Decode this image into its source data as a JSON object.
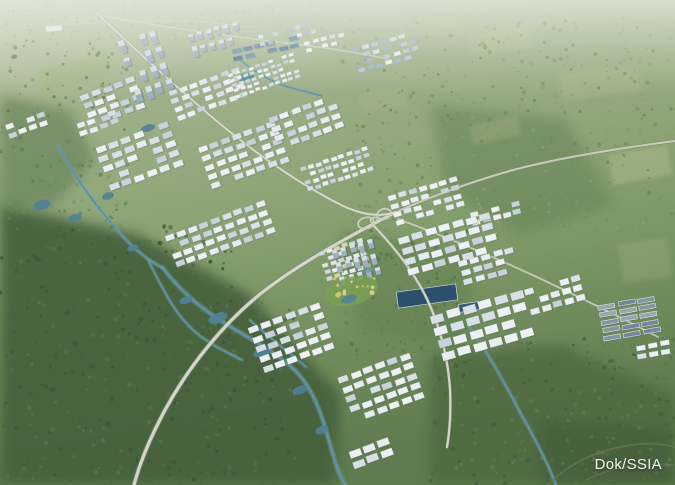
{
  "meta": {
    "credit": "Dok/SSIA",
    "alt": "Aerial masterplan rendering of a large industrial smart-city estate surrounded by green fields and forest"
  },
  "palette": {
    "bgStops": [
      [
        0,
        "#c3cdb3"
      ],
      [
        0.25,
        "#9eb089"
      ],
      [
        0.5,
        "#8ba374"
      ],
      [
        0.75,
        "#75905f"
      ],
      [
        1,
        "#5f7b4f"
      ]
    ],
    "haze": "#e9ede4",
    "water": "#5e93a5",
    "waterGlow": "#7fa9b6",
    "lakeDeep": "#2b506b",
    "roadLight": "#d3d7c8",
    "roadCase": "#7e8770",
    "roofWhite": "#eef1f3",
    "roofBlue": "#d7e0e6",
    "towerBody": "#9db0c0",
    "towerCap": "#d6dfe6",
    "panelBlue": "#5d80a0",
    "creditColor": "#f2f3f1"
  },
  "scene": {
    "regions": [
      {
        "points": "0,205 140,235 250,295 340,395 335,485 0,485",
        "fill": "#46613e",
        "op": 0.92
      },
      {
        "points": "0,95 70,110 95,160 55,205 0,215",
        "fill": "#5d7950",
        "op": 0.55
      },
      {
        "points": "430,105 565,118 615,205 520,235 445,190",
        "fill": "#647f53",
        "op": 0.5
      },
      {
        "points": "430,355 560,345 675,395 675,485 430,485",
        "fill": "#4d6640",
        "op": 0.75
      },
      {
        "points": "540,420 675,430 675,485 540,485",
        "fill": "#3f5838",
        "op": 0.5
      },
      {
        "points": "340,230 470,250 470,350 360,330",
        "fill": "#5f7c4e",
        "op": 0.45
      }
    ],
    "patches": [
      {
        "x": 470,
        "y": 30,
        "w": 60,
        "h": 22,
        "rot": -8,
        "fill": "#b4bf93",
        "op": 0.4
      },
      {
        "x": 560,
        "y": 70,
        "w": 80,
        "h": 26,
        "rot": -6,
        "fill": "#aeb98d",
        "op": 0.4
      },
      {
        "x": 610,
        "y": 150,
        "w": 60,
        "h": 30,
        "rot": -10,
        "fill": "#b7c197",
        "op": 0.4
      },
      {
        "x": 470,
        "y": 120,
        "w": 50,
        "h": 20,
        "rot": -12,
        "fill": "#a9b588",
        "op": 0.35
      },
      {
        "x": 360,
        "y": 90,
        "w": 46,
        "h": 18,
        "rot": -10,
        "fill": "#b0bb90",
        "op": 0.3
      },
      {
        "x": 620,
        "y": 240,
        "w": 50,
        "h": 40,
        "rot": -8,
        "fill": "#9fae82",
        "op": 0.35
      },
      {
        "x": 40,
        "y": 60,
        "w": 70,
        "h": 24,
        "rot": -14,
        "fill": "#9db378",
        "op": 0.3
      }
    ],
    "treeZones": [
      {
        "x": 0,
        "y": 225,
        "w": 235,
        "h": 260,
        "n": 420,
        "rmin": 0.8,
        "rmax": 2.4,
        "colors": [
          "#3c5839",
          "#476441",
          "#54724b"
        ],
        "op": 0.9
      },
      {
        "x": 200,
        "y": 300,
        "w": 95,
        "h": 185,
        "n": 130,
        "rmin": 0.8,
        "rmax": 2.2,
        "colors": [
          "#3c5839",
          "#476441",
          "#54724b"
        ],
        "op": 0.9
      },
      {
        "x": 340,
        "y": 15,
        "w": 335,
        "h": 215,
        "n": 400,
        "rmin": 0.7,
        "rmax": 2.0,
        "colors": [
          "#6d8859",
          "#7b9263",
          "#87a06d"
        ],
        "op": 0.85
      },
      {
        "x": 430,
        "y": 335,
        "w": 245,
        "h": 150,
        "n": 290,
        "rmin": 0.8,
        "rmax": 2.3,
        "colors": [
          "#465f3c",
          "#527046",
          "#5d7b50"
        ],
        "op": 0.9
      },
      {
        "x": 0,
        "y": 40,
        "w": 130,
        "h": 190,
        "n": 160,
        "rmin": 0.8,
        "rmax": 2.2,
        "colors": [
          "#5f7a50",
          "#6c8759",
          "#78935f"
        ],
        "op": 0.85
      },
      {
        "x": 130,
        "y": 0,
        "w": 220,
        "h": 40,
        "n": 110,
        "rmin": 0.6,
        "rmax": 1.6,
        "colors": [
          "#8ba272",
          "#96ab7c"
        ],
        "op": 0.6
      },
      {
        "x": 340,
        "y": 230,
        "w": 130,
        "h": 125,
        "n": 150,
        "rmin": 0.8,
        "rmax": 2.2,
        "colors": [
          "#55744a",
          "#617f52",
          "#6d8a58"
        ],
        "op": 0.85
      },
      {
        "x": 0,
        "y": 0,
        "w": 130,
        "h": 45,
        "n": 60,
        "rmin": 0.6,
        "rmax": 1.6,
        "colors": [
          "#93a87e"
        ],
        "op": 0.55
      }
    ],
    "rivers": [
      {
        "d": "M 58,146 C 74,176 96,206 118,231 C 136,252 151,262 163,268",
        "w": 2.2
      },
      {
        "d": "M 163,268 C 186,299 214,317 236,330 C 261,345 286,359 301,377 C 316,396 323,419 330,444 C 335,463 340,476 345,485",
        "w": 2.6
      },
      {
        "d": "M 148,260 C 163,289 174,313 194,331 C 209,344 226,352 242,360",
        "w": 1.8
      },
      {
        "d": "M 250,320 C 268,337 288,351 306,367",
        "w": 1.6
      },
      {
        "d": "M 470,328 C 489,354 505,384 521,414 C 534,437 547,461 556,485",
        "w": 2.0
      },
      {
        "d": "M 238,58 C 252,70 266,79 282,85 C 296,90 310,92 322,96",
        "w": 1.6
      }
    ],
    "ponds": [
      [
        42,
        205,
        9,
        5,
        -15
      ],
      [
        75,
        218,
        7,
        4,
        -15
      ],
      [
        108,
        196,
        6,
        3.5,
        -15
      ],
      [
        246,
        77,
        8,
        4,
        -12
      ],
      [
        218,
        318,
        10,
        5,
        -20
      ],
      [
        262,
        352,
        9,
        4.5,
        -20
      ],
      [
        300,
        390,
        8,
        4,
        -20
      ],
      [
        322,
        430,
        7,
        4,
        -20
      ],
      [
        133,
        248,
        6,
        3,
        -15
      ],
      [
        186,
        300,
        7,
        3.5,
        -18
      ],
      [
        148,
        128,
        7,
        3.5,
        -15
      ]
    ],
    "lakes": [
      {
        "x": 397,
        "y": 288,
        "w": 60,
        "h": 16,
        "rot": -8,
        "fill": "#2b506b"
      },
      {
        "x": 459,
        "y": 303,
        "w": 20,
        "h": 8,
        "rot": -8,
        "fill": "#335972"
      }
    ],
    "roads": [
      {
        "d": "M 0,31 C 45,26 90,22 132,21 C 170,20 215,22 254,27",
        "w": 1.2,
        "color": "#c4cbb8",
        "op": 0.75
      },
      {
        "d": "M 98,15 C 152,25 212,34 270,41 C 312,46 352,51 388,59",
        "w": 1.4,
        "color": "#ced3c2",
        "op": 0.85
      },
      {
        "d": "M 675,141 C 612,149 548,160 506,172 C 468,183 430,197 396,212",
        "w": 2.0,
        "color": "#c6ccba",
        "case": "#7e8770",
        "cw": 3.4
      },
      {
        "d": "M 396,212 C 348,237 302,262 264,291 C 222,324 188,368 165,410 C 150,438 140,462 134,485",
        "w": 3.2,
        "color": "#d3d7c8",
        "case": "#7e8770",
        "cw": 5
      },
      {
        "d": "M 97,13 C 131,46 172,83 213,118 C 256,154 300,184 341,205 C 360,214 378,218 396,212",
        "w": 2.0,
        "color": "#d6dacb",
        "case": "#8a937e",
        "cw": 3.2
      },
      {
        "d": "M 374,226 C 396,249 414,272 427,299 C 441,329 448,359 450,389 C 451,411 450,430 447,447",
        "w": 2.2,
        "color": "#d2d6c6",
        "case": "#8a937e",
        "cw": 3.2
      },
      {
        "d": "M 398,219 C 444,236 492,256 541,279 C 577,296 618,316 658,337",
        "w": 1.8,
        "color": "#c9cfbc",
        "op": 0.9
      },
      {
        "d": "M 548,485 C 570,462 600,448 640,444 C 652,443 664,444 675,447",
        "w": 1.8,
        "color": "#667557",
        "op": 0.8
      },
      {
        "d": "M 675,465 C 640,462 610,468 586,480",
        "w": 1.5,
        "color": "#667557",
        "op": 0.7
      }
    ],
    "loops": [
      {
        "cx": 366,
        "cy": 223,
        "rx": 8,
        "ry": 5.5,
        "rot": -15
      },
      {
        "cx": 384,
        "cy": 214,
        "rx": 7,
        "ry": 5,
        "rot": -15
      },
      {
        "cx": 374,
        "cy": 220,
        "rx": 3.5,
        "ry": 2.6,
        "rot": -15
      }
    ],
    "clusters": [
      {
        "x": 80,
        "y": 96,
        "rot": -20,
        "r": 4,
        "c": 5,
        "w": 9,
        "h": 5.5,
        "gx": 3,
        "gy": 3.5
      },
      {
        "x": 95,
        "y": 148,
        "rot": -20,
        "r": 5,
        "c": 6,
        "w": 10,
        "h": 6,
        "gx": 3.5,
        "gy": 4
      },
      {
        "x": 168,
        "y": 92,
        "rot": -20,
        "r": 4,
        "c": 7,
        "w": 8,
        "h": 5,
        "gx": 3,
        "gy": 3.5
      },
      {
        "x": 228,
        "y": 74,
        "rot": -18,
        "r": 5,
        "c": 10,
        "w": 5,
        "h": 3.2,
        "gx": 2,
        "gy": 2.4
      },
      {
        "x": 232,
        "y": 50,
        "rot": -12,
        "r": 2,
        "c": 6,
        "w": 9,
        "h": 4,
        "gx": 2.5,
        "gy": 3,
        "f": [
          "#5d80a0",
          "#6b8cab",
          "#54769a"
        ]
      },
      {
        "x": 258,
        "y": 36,
        "rot": -14,
        "r": 2,
        "c": 8,
        "w": 5,
        "h": 4,
        "gx": 2.5,
        "gy": 3,
        "f": [
          "#e8edf0",
          "#c7d4dd",
          "#9fb4c6"
        ]
      },
      {
        "x": 304,
        "y": 42,
        "rot": -14,
        "r": 2,
        "c": 5,
        "w": 6,
        "h": 4,
        "gx": 2.5,
        "gy": 3
      },
      {
        "x": 352,
        "y": 48,
        "rot": -15,
        "r": 4,
        "c": 7,
        "w": 7,
        "h": 4.2,
        "gx": 2.5,
        "gy": 3,
        "f": [
          "#e8edf0",
          "#d7e0e6",
          "#9fb4c6",
          "#b9c7d4"
        ]
      },
      {
        "x": 198,
        "y": 148,
        "rot": -20,
        "r": 5,
        "c": 7,
        "w": 9,
        "h": 5.5,
        "gx": 3,
        "gy": 4
      },
      {
        "x": 268,
        "y": 118,
        "rot": -20,
        "r": 4,
        "c": 6,
        "w": 9,
        "h": 5.5,
        "gx": 3,
        "gy": 4
      },
      {
        "x": 300,
        "y": 168,
        "rot": -18,
        "r": 4,
        "c": 9,
        "w": 6,
        "h": 4,
        "gx": 2,
        "gy": 3
      },
      {
        "x": 388,
        "y": 196,
        "rot": -16,
        "r": 4,
        "c": 7,
        "w": 8,
        "h": 5,
        "gx": 2.5,
        "gy": 3.5
      },
      {
        "x": 470,
        "y": 213,
        "rot": -15,
        "r": 2,
        "c": 5,
        "w": 8,
        "h": 5,
        "gx": 2.5,
        "gy": 3.5
      },
      {
        "x": 398,
        "y": 238,
        "rot": -16,
        "r": 4,
        "c": 7,
        "w": 11,
        "h": 6.5,
        "gx": 3,
        "gy": 4.5
      },
      {
        "x": 458,
        "y": 262,
        "rot": -16,
        "r": 3,
        "c": 5,
        "w": 9,
        "h": 5.5,
        "gx": 3,
        "gy": 4
      },
      {
        "x": 430,
        "y": 316,
        "rot": -16,
        "r": 4,
        "c": 6,
        "w": 13,
        "h": 8,
        "gx": 3.5,
        "gy": 5
      },
      {
        "x": 524,
        "y": 290,
        "rot": -16,
        "r": 3,
        "c": 5,
        "w": 9,
        "h": 6,
        "gx": 3,
        "gy": 4
      },
      {
        "x": 598,
        "y": 306,
        "rot": -10,
        "r": 5,
        "c": 3,
        "w": 17,
        "h": 4.5,
        "gx": 3,
        "gy": 3.2,
        "f": [
          "#8695a4",
          "#98a6b2",
          "#76869a"
        ],
        "ridge": true,
        "skip": 0.04
      },
      {
        "x": 636,
        "y": 346,
        "rot": -10,
        "r": 2,
        "c": 3,
        "w": 9,
        "h": 5,
        "gx": 3,
        "gy": 3.5
      },
      {
        "x": 165,
        "y": 236,
        "rot": -20,
        "r": 4,
        "c": 9,
        "w": 9,
        "h": 5.5,
        "gx": 3,
        "gy": 4
      },
      {
        "x": 248,
        "y": 328,
        "rot": -20,
        "r": 5,
        "c": 6,
        "w": 10,
        "h": 6,
        "gx": 3,
        "gy": 4.5
      },
      {
        "x": 338,
        "y": 378,
        "rot": -20,
        "r": 5,
        "c": 6,
        "w": 10,
        "h": 6,
        "gx": 3,
        "gy": 4.5
      },
      {
        "x": 348,
        "y": 452,
        "rot": -20,
        "r": 2,
        "c": 3,
        "w": 12,
        "h": 7,
        "gx": 3,
        "gy": 4
      },
      {
        "x": 5,
        "y": 126,
        "rot": -20,
        "r": 2,
        "c": 4,
        "w": 8,
        "h": 5,
        "gx": 3,
        "gy": 3.5
      },
      {
        "x": 76,
        "y": 124,
        "rot": -20,
        "r": 2,
        "c": 4,
        "w": 8,
        "h": 5,
        "gx": 3,
        "gy": 3.5
      },
      {
        "x": 318,
        "y": 252,
        "rot": -18,
        "r": 5,
        "c": 6,
        "w": 6,
        "h": 4,
        "gx": 2,
        "gy": 2.6,
        "f": [
          "#e9edef",
          "#dfe5e2",
          "#d8d2a4",
          "#cfd8de"
        ]
      },
      {
        "x": 118,
        "y": 42,
        "rot": -18,
        "r": 4,
        "c": 4,
        "w": 6,
        "h": 11,
        "gx": 5,
        "gy": 6,
        "type": "towers"
      },
      {
        "x": 188,
        "y": 34,
        "rot": -15,
        "r": 2,
        "c": 6,
        "w": 5,
        "h": 9,
        "gx": 4,
        "gy": 5,
        "type": "towers"
      },
      {
        "x": 332,
        "y": 250,
        "rot": -15,
        "r": 3,
        "c": 5,
        "w": 5,
        "h": 9,
        "gx": 4,
        "gy": 5,
        "type": "towers"
      }
    ],
    "marks": [
      {
        "t": "rect",
        "x": 46,
        "y": 26,
        "w": 16,
        "h": 5,
        "rot": -4,
        "fill": "#edefe9",
        "op": 0.95
      },
      {
        "t": "ellipse",
        "cx": 352,
        "cy": 291,
        "rx": 27,
        "ry": 14,
        "rot": -15,
        "fill": "#7aa053",
        "op": 0.8
      },
      {
        "t": "dots",
        "cx": 354,
        "cy": 288,
        "spread": 22,
        "n": 16,
        "rmin": 1,
        "rmax": 2.4,
        "fills": [
          "#d6cb7f",
          "#cfc06e",
          "#e0d78f"
        ]
      },
      {
        "t": "ellipse",
        "cx": 349,
        "cy": 299,
        "rx": 8,
        "ry": 4,
        "rot": -15,
        "fill": "#4f8499",
        "op": 0.9
      },
      {
        "t": "ellipse",
        "cx": 368,
        "cy": 270,
        "rx": 6,
        "ry": 3,
        "rot": -15,
        "fill": "#5e93a5",
        "op": 0.8
      }
    ]
  }
}
